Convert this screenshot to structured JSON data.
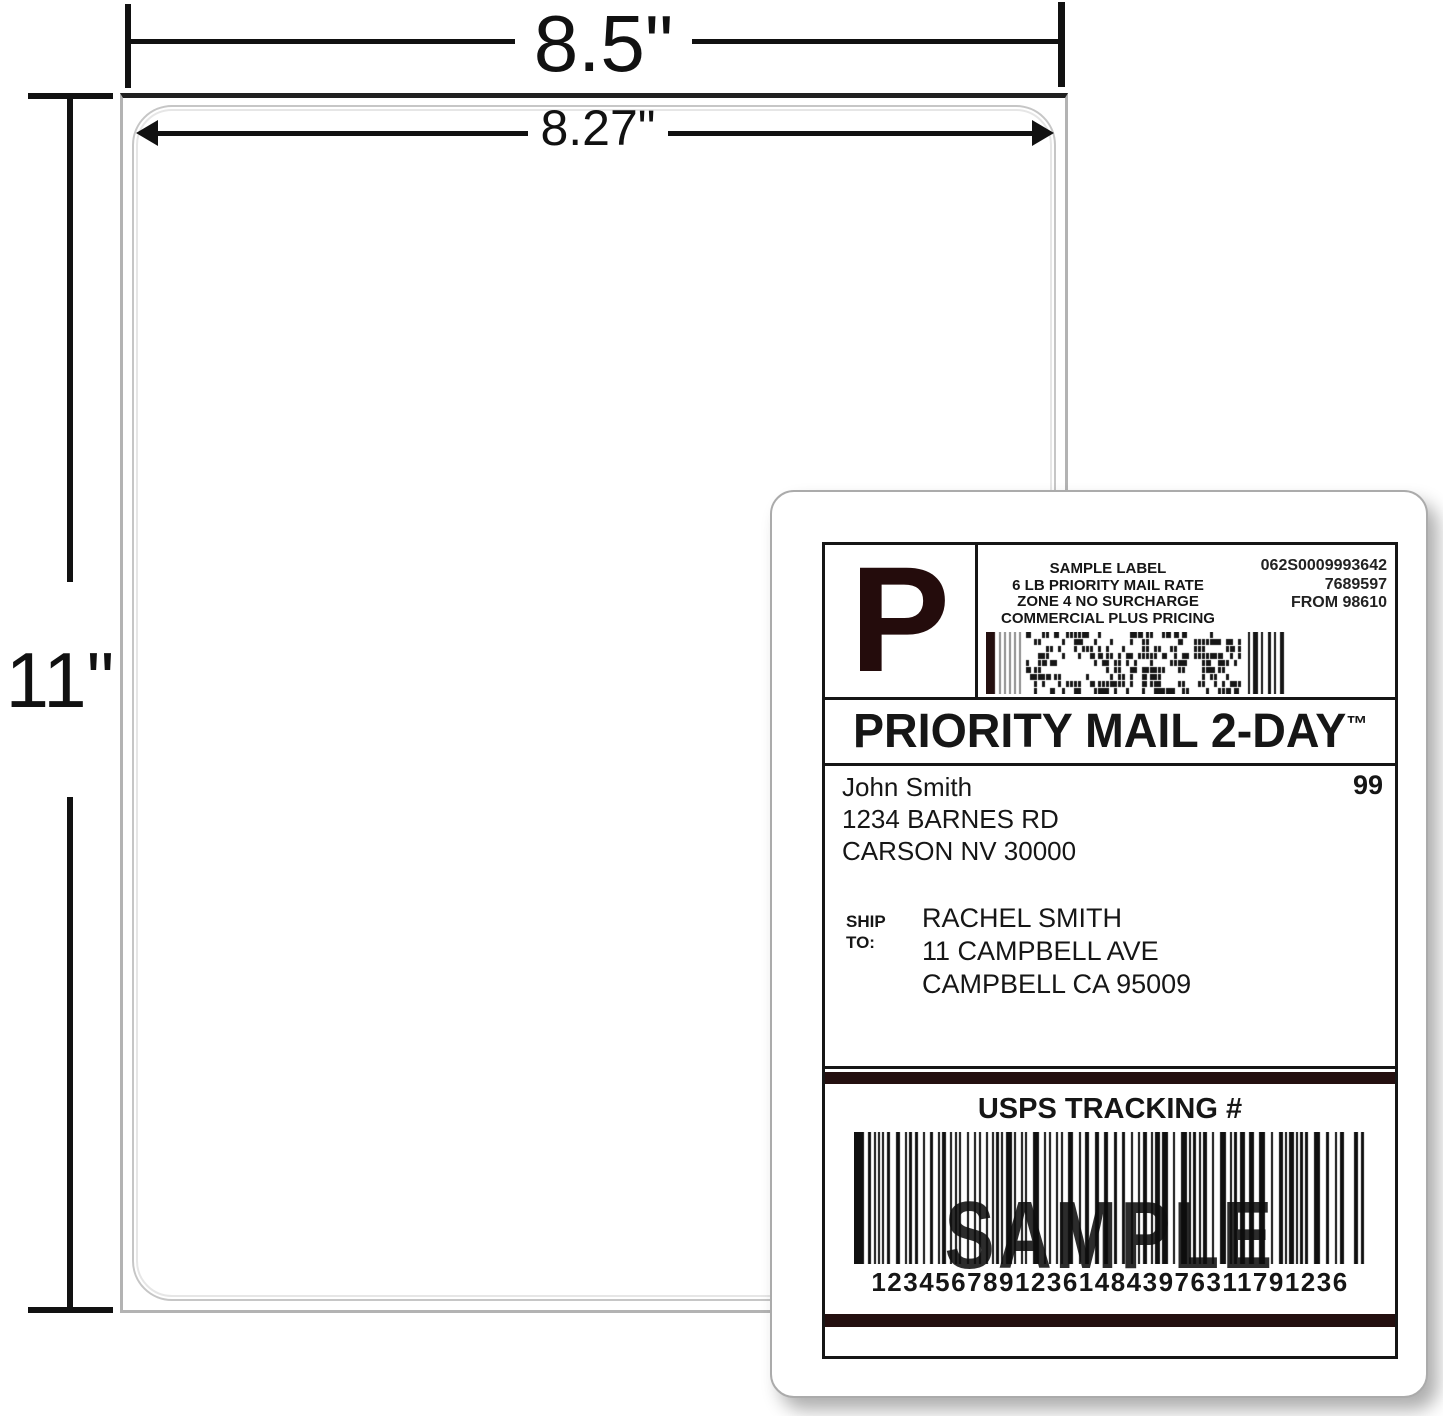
{
  "annotations": {
    "sheet_width": "8.5\"",
    "printable_width": "8.27\"",
    "sheet_height": "11\""
  },
  "label": {
    "service_indicator": "P",
    "header_center": [
      "SAMPLE LABEL",
      "6 LB PRIORITY MAIL RATE",
      "ZONE 4 NO SURCHARGE",
      "COMMERCIAL PLUS PRICING"
    ],
    "header_right": [
      "062S0009993642",
      "7689597",
      "FROM 98610"
    ],
    "banner_text": "PRIORITY MAIL 2-DAY",
    "banner_trademark": "™",
    "sender_lines": [
      "John Smith",
      "1234 BARNES RD",
      "CARSON NV 30000"
    ],
    "zone_code": "99",
    "ship_to_lines": [
      "SHIP",
      "TO:"
    ],
    "recipient_lines": [
      "RACHEL SMITH",
      "11 CAMPBELL AVE",
      "CAMPBELL CA 95009"
    ],
    "tracking_heading": "USPS TRACKING #",
    "watermark": "SAMPLE",
    "tracking_digits": "123456789123614843976311791236"
  },
  "colors": {
    "ink": "#161616",
    "maroon_black": "#240f0f",
    "dimension_line": "#111111",
    "sheet_border": "#b3b3b3",
    "sheet_top_edge": "#202020",
    "diecut_outline": "#c6c6c6"
  }
}
